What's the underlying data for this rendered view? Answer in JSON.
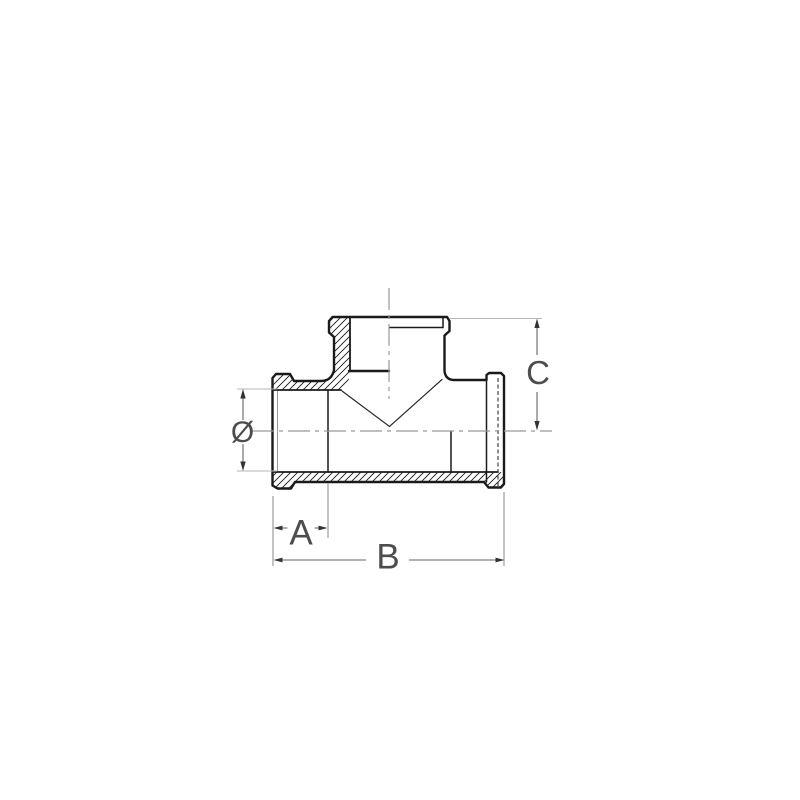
{
  "page": {
    "background": "#ffffff"
  },
  "drawing": {
    "figure": "tee-fitting-cross-section",
    "labels": {
      "diameter": "Ø",
      "a": "A",
      "b": "B",
      "c": "C"
    }
  },
  "colors": {
    "background": "#ffffff",
    "outline": "#1a1a1a",
    "hatch": "#1a1a1a",
    "centerline": "#999999",
    "dimension_line": "#666666",
    "arrow": "#333333",
    "extension_light": "#b5b5b5",
    "label": "#4d4d4d"
  }
}
